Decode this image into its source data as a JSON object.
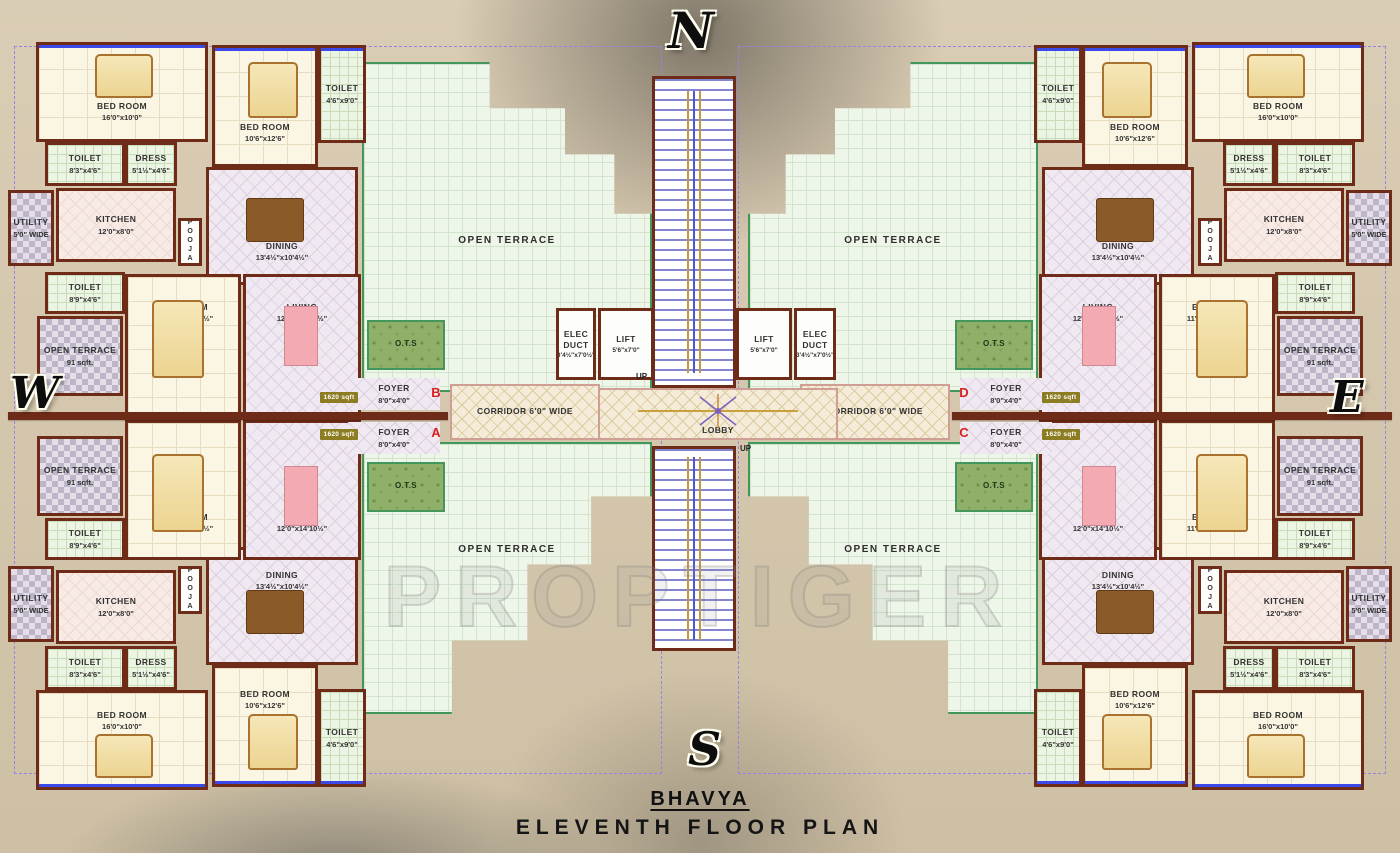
{
  "title": {
    "building": "BHAVYA",
    "plan": "ELEVENTH FLOOR PLAN"
  },
  "watermark": "PROPTIGER",
  "compass": {
    "north": "N",
    "south": "S",
    "east": "E",
    "west": "W"
  },
  "units": {
    "a": "A",
    "b": "B",
    "c": "C",
    "d": "D"
  },
  "area_badge": "1620 sqft",
  "stairs_up_label": "UP",
  "rooms": {
    "bedroom_16x10": {
      "name": "BED ROOM",
      "dims": "16'0\"x10'0\""
    },
    "bedroom_106x126": {
      "name": "BED ROOM",
      "dims": "10'6\"x12'6\""
    },
    "bedroom_master": {
      "name": "BED ROOM",
      "dims": "11'10½\"x14'10½\""
    },
    "living": {
      "name": "LIVING",
      "dims": "12'0\"x14'10½\""
    },
    "dining": {
      "name": "DINING",
      "dims": "13'4½\"x10'4½\""
    },
    "kitchen": {
      "name": "KITCHEN",
      "dims": "12'0\"x8'0\""
    },
    "utility": {
      "name": "UTILITY",
      "dims": "5'0\" WIDE"
    },
    "pooja": {
      "name": "POOJA"
    },
    "dress": {
      "name": "DRESS",
      "dims": "5'1½\"x4'6\""
    },
    "toilet_46x90": {
      "name": "TOILET",
      "dims": "4'6\"x9'0\""
    },
    "toilet_83x46": {
      "name": "TOILET",
      "dims": "8'3\"x4'6\""
    },
    "toilet_89x46": {
      "name": "TOILET",
      "dims": "8'9\"x4'6\""
    },
    "open_terrace_91": {
      "name": "OPEN TERRACE",
      "dims": "91 sqft."
    },
    "open_terrace": {
      "name": "OPEN TERRACE"
    },
    "ots": {
      "name": "O.T.S"
    },
    "foyer": {
      "name": "FOYER",
      "dims": "8'0\"x4'0\""
    },
    "corridor": {
      "name": "CORRIDOR 6'0\" WIDE"
    },
    "lobby": {
      "name": "LOBBY"
    },
    "lift": {
      "name": "LIFT",
      "dims": "5'6\"x7'0\""
    },
    "elec_duct": {
      "name": "ELEC DUCT",
      "dims": "3'4½\"x7'0½\""
    }
  },
  "colors": {
    "wall": "#6e2c18",
    "terrace_border": "#43975a",
    "unit_letter": "#d81f1f",
    "badge_bg": "#8c7c22",
    "window_accent": "#3a49e8"
  }
}
